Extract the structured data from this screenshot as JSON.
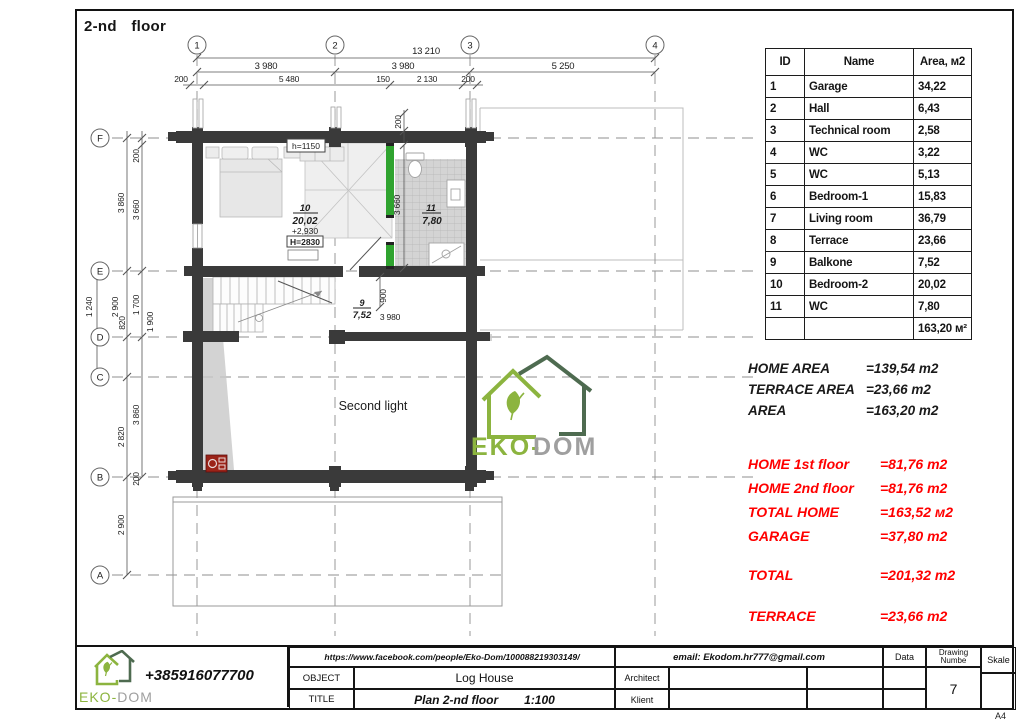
{
  "sheet": {
    "title": "2-nd  floor",
    "paper": "A4"
  },
  "room_table": {
    "headers": {
      "id": "ID",
      "name": "Name",
      "area": "Area, м2"
    },
    "rows": [
      {
        "id": "1",
        "name": "Garage",
        "area": "34,22"
      },
      {
        "id": "2",
        "name": "Hall",
        "area": "6,43"
      },
      {
        "id": "3",
        "name": "Technical room",
        "area": "2,58"
      },
      {
        "id": "4",
        "name": "WC",
        "area": "3,22"
      },
      {
        "id": "5",
        "name": "WC",
        "area": "5,13"
      },
      {
        "id": "6",
        "name": "Bedroom-1",
        "area": "15,83"
      },
      {
        "id": "7",
        "name": "Living room",
        "area": "36,79"
      },
      {
        "id": "8",
        "name": "Terrace",
        "area": "23,66"
      },
      {
        "id": "9",
        "name": "Balkone",
        "area": "7,52"
      },
      {
        "id": "10",
        "name": "Bedroom-2",
        "area": "20,02"
      },
      {
        "id": "11",
        "name": "WC",
        "area": "7,80"
      }
    ],
    "total": "163,20 м²"
  },
  "area_summary": [
    {
      "label": "HOME AREA",
      "value": "=139,54 m2"
    },
    {
      "label": "TERRACE AREA",
      "value": "=23,66 m2"
    },
    {
      "label": "AREA",
      "value": "=163,20 m2"
    }
  ],
  "area_summary_red": [
    {
      "label": "HOME 1st floor",
      "value": "=81,76 m2"
    },
    {
      "label": "HOME 2nd floor",
      "value": "=81,76 m2"
    },
    {
      "label": "TOTAL HOME",
      "value": "=163,52 м2"
    },
    {
      "label": "GARAGE",
      "value": "=37,80 m2"
    },
    {
      "label": "TOTAL",
      "value": "=201,32 m2"
    },
    {
      "label": "TERRACE",
      "value": "=23,66 m2"
    }
  ],
  "plan": {
    "grid_cols": [
      "1",
      "2",
      "3",
      "4"
    ],
    "grid_rows": [
      "F",
      "E",
      "D",
      "C",
      "B",
      "A"
    ],
    "dims_top": {
      "total": "13 210",
      "seg1": "3 980",
      "seg2": "3 980",
      "seg3": "5 250",
      "c1": "200",
      "c2": "5 480",
      "c3": "150",
      "c4": "2 130",
      "c5": "200"
    },
    "dims_left": {
      "fe_out": "3 860",
      "fe_in": "3 660",
      "f_wall": "200",
      "ed_out": "1 240",
      "ed_mid": "2 900",
      "ed_mid2": "820",
      "ed_in": "1 700",
      "ed_in2": "1 900",
      "cb_out": "2 820",
      "cb_in": "3 860",
      "b_wall": "200",
      "ba": "2 900"
    },
    "dims_inner": {
      "wall200": "200",
      "wc_h": "3 660",
      "balk_h": "900",
      "balk_w": "3 980"
    },
    "room10": {
      "num": "10",
      "area": "20,02",
      "elev": "+2,930",
      "height": "H=2830"
    },
    "room11": {
      "num": "11",
      "area": "7,80"
    },
    "room9": {
      "num": "9",
      "area": "7,52"
    },
    "labels": {
      "h_window": "h=1150",
      "second_light": "Second light"
    },
    "watermark": {
      "green": "EKO-",
      "gray": "DOM"
    }
  },
  "title_block": {
    "phone": "+385916077700",
    "logo": {
      "green": "EKO-",
      "gray": "DOM"
    },
    "facebook": "https://www.facebook.com/people/Eko-Dom/100088219303149/",
    "email": "email: Ekodom.hr777@gmail.com",
    "object_label": "OBJECT",
    "object_value": "Log House",
    "title_label": "TITLE",
    "title_value": "Plan 2-nd floor",
    "scale_value": "1:100",
    "architect_label": "Architect",
    "klient_label": "Klient",
    "data_label": "Data",
    "drawing_number_label_1": "Drawing",
    "drawing_number_label_2": "Numbe",
    "drawing_number": "7",
    "skale_label": "Skale"
  },
  "colors": {
    "wall": "#3a3a3a",
    "accent_green": "#2fa32f",
    "logo_green": "#8cb43f",
    "logo_dark_green": "#4e6b50",
    "red_text": "#ff0000",
    "fireplace_red": "#9b2318"
  }
}
